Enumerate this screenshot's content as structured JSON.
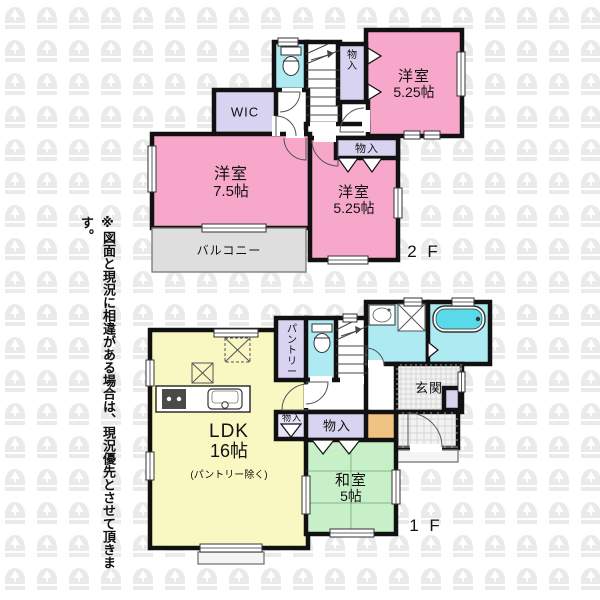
{
  "disclaimer_note": "※図面と現況に相違がある場合は、現況優先とさせて頂きます。",
  "floor_labels": [
    {
      "id": "2f",
      "text": "2 F",
      "x": 424,
      "y": 257
    },
    {
      "id": "1f",
      "text": "1 F",
      "x": 426,
      "y": 531
    }
  ],
  "palette": {
    "wall": "#111111",
    "pink": "#F7A7CA",
    "purple": "#D8D3F0",
    "purpleLight": "#E6E2F7",
    "cyan": "#ADEAF1",
    "yellow": "#F9F8C2",
    "green": "#C7F0C8",
    "gray": "#DEDEDE",
    "orange": "#F1C383",
    "white": "#FFFFFF",
    "tile": "#F2F2F2",
    "tub": "#59DAE8",
    "watermark": "#EAEAEA",
    "grid": "#CCCCCC",
    "porch": "#F5F5F5"
  },
  "rooms": [
    {
      "id": "toilet-2f",
      "floor": "2F",
      "label": "",
      "color": "cyan",
      "rect": [
        274,
        42,
        34,
        50
      ]
    },
    {
      "id": "stairs-2f",
      "floor": "2F",
      "label": "",
      "color": "white",
      "rect": [
        306,
        42,
        34,
        84
      ]
    },
    {
      "id": "bedroom-525-top",
      "floor": "2F",
      "label": "洋室",
      "sublabel": "5.25帖",
      "color": "pink",
      "rect": [
        366,
        30,
        96,
        106
      ],
      "fs": 15
    },
    {
      "id": "closet-2f-top",
      "floor": "2F",
      "label": "物入",
      "vertical": true,
      "color": "purple",
      "rect": [
        338,
        44,
        28,
        60
      ],
      "fs": 10
    },
    {
      "id": "hall-2f",
      "floor": "2F",
      "label": "",
      "color": "white",
      "rect": [
        274,
        90,
        34,
        48
      ]
    },
    {
      "id": "hall-2f-b",
      "floor": "2F",
      "label": "",
      "color": "white",
      "rect": [
        340,
        102,
        28,
        38
      ]
    },
    {
      "id": "hall-2f-c",
      "floor": "2F",
      "label": "",
      "color": "white",
      "rect": [
        306,
        124,
        62,
        16
      ]
    },
    {
      "id": "wic",
      "floor": "2F",
      "label": "WIC",
      "color": "purple",
      "rect": [
        214,
        90,
        62,
        44
      ],
      "fs": 13
    },
    {
      "id": "bedroom-75",
      "floor": "2F",
      "label": "洋室",
      "sublabel": "7.5帖",
      "color": "pink",
      "rect": [
        152,
        134,
        158,
        94
      ],
      "fs": 16
    },
    {
      "id": "bedroom-525-mid",
      "floor": "2F",
      "label": "洋室",
      "sublabel": "5.25帖",
      "color": "pink",
      "rect": [
        310,
        138,
        88,
        122
      ],
      "fs": 15
    },
    {
      "id": "closet-2f-mid",
      "floor": "2F",
      "label": "物入",
      "color": "purple",
      "rect": [
        336,
        138,
        62,
        20
      ],
      "fs": 11
    },
    {
      "id": "balcony",
      "floor": "2F",
      "label": "バルコニー",
      "color": "gray",
      "thin": true,
      "rect": [
        152,
        228,
        154,
        44
      ],
      "fs": 12
    },
    {
      "id": "ldk",
      "floor": "1F",
      "label": "LDK",
      "sublabel": "16帖",
      "note": "(パントリー除く)",
      "color": "yellow",
      "rect": [
        150,
        330,
        158,
        218
      ],
      "fs": 19
    },
    {
      "id": "pantry",
      "floor": "1F",
      "label": "パントリー",
      "vertical": true,
      "color": "purple",
      "rect": [
        276,
        318,
        32,
        62
      ],
      "fs": 10
    },
    {
      "id": "toilet-1f",
      "floor": "1F",
      "label": "",
      "color": "cyan",
      "rect": [
        306,
        318,
        32,
        62
      ]
    },
    {
      "id": "stairs-1f",
      "floor": "1F",
      "label": "",
      "color": "white",
      "rect": [
        336,
        318,
        32,
        62
      ]
    },
    {
      "id": "washroom",
      "floor": "1F",
      "label": "",
      "color": "cyan",
      "rect": [
        366,
        302,
        62,
        62
      ]
    },
    {
      "id": "bathroom",
      "floor": "1F",
      "label": "",
      "color": "cyan",
      "rect": [
        428,
        302,
        62,
        62
      ]
    },
    {
      "id": "hall-1f",
      "floor": "1F",
      "label": "",
      "color": "white",
      "rect": [
        306,
        380,
        92,
        32
      ]
    },
    {
      "id": "hall-1f-front",
      "floor": "1F",
      "label": "",
      "color": "white",
      "rect": [
        366,
        364,
        32,
        50
      ]
    },
    {
      "id": "genkan",
      "floor": "1F",
      "label": "玄関",
      "color": "tile",
      "tilegrid": 5,
      "rect": [
        396,
        364,
        66,
        48
      ],
      "fs": 13
    },
    {
      "id": "shoe-cabinet",
      "floor": "1F",
      "label": "",
      "color": "purple",
      "rect": [
        444,
        388,
        16,
        22
      ]
    },
    {
      "id": "doma",
      "floor": "1F",
      "label": "",
      "color": "tile",
      "tilegrid": 7,
      "rect": [
        396,
        412,
        62,
        36
      ]
    },
    {
      "id": "entrance-porch",
      "floor": "1F",
      "label": "",
      "color": "porch",
      "thin": true,
      "rect": [
        396,
        450,
        62,
        12
      ]
    },
    {
      "id": "closet-1f-small",
      "floor": "1F",
      "label": "物入",
      "color": "purpleLight",
      "rect": [
        276,
        412,
        32,
        27
      ],
      "fs": 9,
      "labelTop": true
    },
    {
      "id": "closet-1f",
      "floor": "1F",
      "label": "物入",
      "color": "purple",
      "rect": [
        306,
        412,
        62,
        28
      ],
      "fs": 13
    },
    {
      "id": "tokonoma",
      "floor": "1F",
      "label": "",
      "color": "orange",
      "rect": [
        366,
        412,
        30,
        29
      ]
    },
    {
      "id": "washitsu",
      "floor": "1F",
      "label": "和室",
      "sublabel": "5帖",
      "color": "green",
      "rect": [
        306,
        440,
        90,
        94
      ],
      "fs": 15
    },
    {
      "id": "ldk-terrace",
      "floor": "1F",
      "label": "",
      "color": "porch",
      "thin": true,
      "rect": [
        198,
        552,
        66,
        12
      ]
    }
  ],
  "windows": [
    {
      "rect": [
        278,
        38,
        20,
        8
      ]
    },
    {
      "rect": [
        457,
        52,
        8,
        44
      ]
    },
    {
      "rect": [
        404,
        131,
        16,
        8
      ]
    },
    {
      "rect": [
        424,
        131,
        16,
        8
      ]
    },
    {
      "rect": [
        394,
        188,
        8,
        30
      ]
    },
    {
      "rect": [
        328,
        256,
        40,
        8
      ]
    },
    {
      "rect": [
        148,
        146,
        8,
        46
      ]
    },
    {
      "rect": [
        202,
        224,
        64,
        8
      ]
    },
    {
      "rect": [
        214,
        329,
        44,
        8
      ]
    },
    {
      "rect": [
        343,
        314,
        14,
        8
      ]
    },
    {
      "rect": [
        404,
        298,
        18,
        8
      ]
    },
    {
      "rect": [
        452,
        298,
        22,
        8
      ]
    },
    {
      "rect": [
        146,
        360,
        8,
        26
      ]
    },
    {
      "rect": [
        146,
        452,
        8,
        28
      ]
    },
    {
      "rect": [
        200,
        544,
        62,
        8
      ]
    },
    {
      "rect": [
        330,
        529,
        44,
        8
      ]
    },
    {
      "rect": [
        392,
        470,
        8,
        34
      ]
    },
    {
      "rect": [
        458,
        372,
        7,
        20
      ]
    },
    {
      "rect": [
        302,
        476,
        8,
        38
      ]
    }
  ],
  "door_gaps": [
    {
      "rect": [
        282,
        88,
        20,
        8
      ]
    },
    {
      "rect": [
        272,
        116,
        8,
        20
      ]
    },
    {
      "rect": [
        362,
        110,
        8,
        22
      ]
    },
    {
      "rect": [
        314,
        134,
        22,
        8
      ]
    },
    {
      "rect": [
        286,
        130,
        18,
        8
      ]
    },
    {
      "rect": [
        310,
        122,
        26,
        8
      ]
    },
    {
      "rect": [
        310,
        376,
        22,
        8
      ]
    },
    {
      "rect": [
        304,
        384,
        8,
        24
      ]
    },
    {
      "rect": [
        368,
        360,
        16,
        8
      ]
    },
    {
      "rect": [
        410,
        444,
        32,
        8
      ]
    },
    {
      "rect": [
        340,
        376,
        24,
        8
      ]
    }
  ],
  "doors": [
    {
      "cx": 280,
      "cy": 92,
      "r": 20,
      "a0": 0,
      "a1": 90
    },
    {
      "cx": 276,
      "cy": 136,
      "r": 20,
      "a0": 270,
      "a1": 360
    },
    {
      "cx": 364,
      "cy": 132,
      "r": 24,
      "a0": 180,
      "a1": 270
    },
    {
      "cx": 338,
      "cy": 140,
      "r": 26,
      "a0": 90,
      "a1": 180
    },
    {
      "cx": 306,
      "cy": 138,
      "r": 22,
      "a0": 90,
      "a1": 180
    },
    {
      "cx": 306,
      "cy": 382,
      "r": 22,
      "a0": 0,
      "a1": 90
    },
    {
      "cx": 308,
      "cy": 410,
      "r": 26,
      "a0": 180,
      "a1": 270
    },
    {
      "cx": 366,
      "cy": 366,
      "r": 18,
      "a0": 270,
      "a1": 360
    },
    {
      "cx": 408,
      "cy": 447,
      "r": 34,
      "a0": 270,
      "a1": 360
    }
  ],
  "bifold_marks": [
    {
      "pts": [
        [
          368,
          48
        ],
        [
          381,
          56
        ],
        [
          368,
          64
        ]
      ]
    },
    {
      "pts": [
        [
          368,
          84
        ],
        [
          381,
          92
        ],
        [
          368,
          100
        ]
      ]
    },
    {
      "pts": [
        [
          338,
          158
        ],
        [
          348,
          172
        ],
        [
          358,
          158
        ]
      ]
    },
    {
      "pts": [
        [
          362,
          158
        ],
        [
          372,
          172
        ],
        [
          382,
          158
        ]
      ]
    },
    {
      "pts": [
        [
          312,
          440
        ],
        [
          323,
          454
        ],
        [
          334,
          440
        ]
      ]
    },
    {
      "pts": [
        [
          338,
          440
        ],
        [
          349,
          454
        ],
        [
          360,
          440
        ]
      ]
    },
    {
      "pts": [
        [
          281,
          424
        ],
        [
          291,
          437
        ],
        [
          301,
          424
        ]
      ]
    },
    {
      "pts": [
        [
          428,
          342
        ],
        [
          438,
          350
        ],
        [
          428,
          358
        ]
      ]
    }
  ],
  "fixtures": [
    {
      "type": "toilet",
      "rect": [
        281,
        47,
        20,
        28
      ]
    },
    {
      "type": "toilet",
      "rect": [
        312,
        324,
        20,
        28
      ]
    },
    {
      "type": "stairs",
      "rect": [
        306,
        42,
        34,
        84
      ],
      "dir": "down"
    },
    {
      "type": "stairs",
      "rect": [
        336,
        318,
        32,
        62
      ],
      "dir": "up"
    },
    {
      "type": "washbasin",
      "rect": [
        369,
        305,
        26,
        20
      ]
    },
    {
      "type": "washer",
      "rect": [
        398,
        304,
        27,
        27
      ]
    },
    {
      "type": "bathtub",
      "rect": [
        433,
        306,
        52,
        26
      ]
    },
    {
      "type": "kitchen",
      "rect": [
        156,
        386,
        94,
        26
      ]
    },
    {
      "type": "hatch-dashed",
      "rect": [
        225,
        338,
        25,
        24
      ]
    },
    {
      "type": "hatch",
      "rect": [
        192,
        363,
        21,
        20
      ]
    },
    {
      "type": "tatami",
      "rect": [
        306,
        440,
        90,
        94
      ]
    }
  ]
}
